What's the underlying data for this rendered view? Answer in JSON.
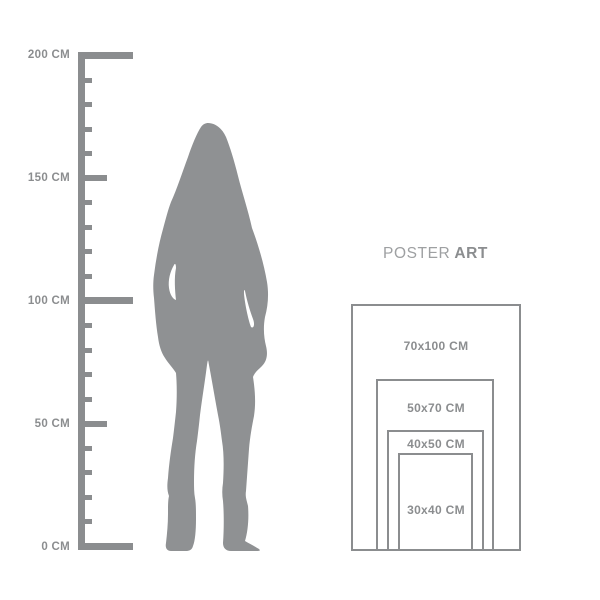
{
  "ruler": {
    "unit": "CM",
    "labels": [
      "200 CM",
      "150 CM",
      "100 CM",
      "50 CM",
      "0 CM"
    ],
    "values": [
      200,
      150,
      100,
      50,
      0
    ]
  },
  "figure": {
    "description": "standing-woman-silhouette"
  },
  "poster": {
    "title_regular": "POSTER",
    "title_bold": "ART",
    "sizes": [
      "70x100 CM",
      "50x70 CM",
      "40x50 CM",
      "30x40 CM"
    ]
  },
  "colors": {
    "gray": "#8b8d8f",
    "gray_light": "#9ea0a2",
    "silhouette": "#8f9193",
    "background": "#ffffff"
  }
}
